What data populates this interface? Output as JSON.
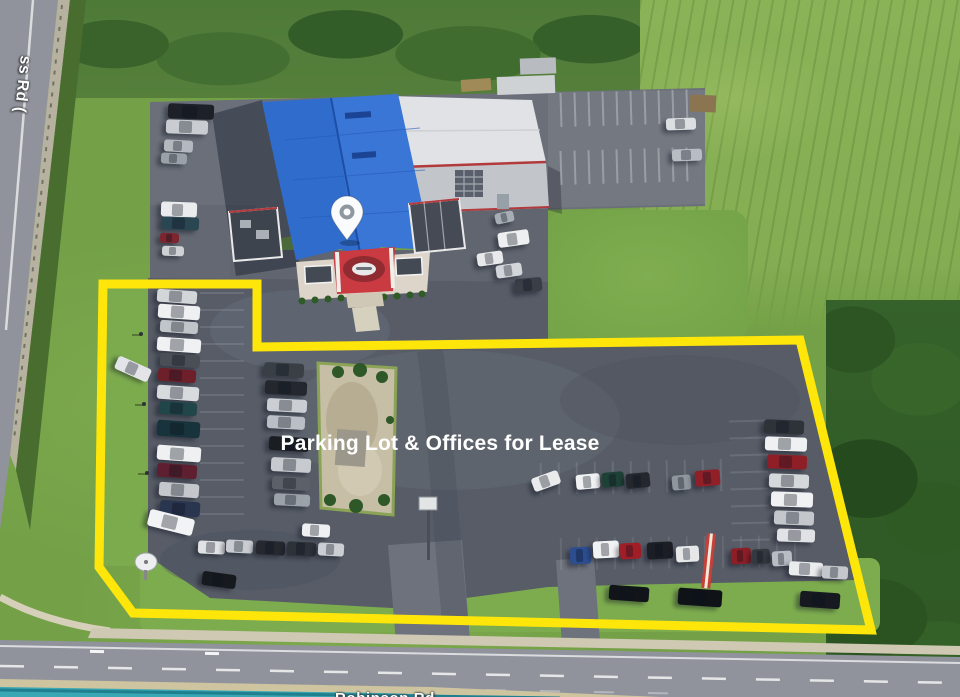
{
  "title": "Aerial property photo with lease highlight",
  "banner": {
    "label": "Parking Lot & Offices for Lease",
    "background": "#e32128",
    "text_color": "#ffffff"
  },
  "map_labels": {
    "bottom_road": "Robinson Rd",
    "left_road_fragment": "ss Rd ("
  },
  "marker": {
    "name": "location-pin",
    "fill": "#fafbfc",
    "dot": "#8f979f"
  },
  "lease_outline": {
    "color": "#ffe60a",
    "stroke_width": "9",
    "points": "103,284 257,284 257,347 800,340 871,630 133,613 99,567"
  },
  "palette": {
    "banner_red": "#e32128",
    "outline_yellow": "#ffe60a",
    "roof_blue": "#2f6ccb",
    "roof_white": "#e0e2e5",
    "asphalt": "#575c67",
    "road_gray": "#90939b",
    "grass": "#74a147",
    "trees_dark": "#2f5a24",
    "stream_teal": "#3aa7b4"
  },
  "scene": {
    "car_fields": [
      "x",
      "y",
      "w",
      "h",
      "angle_deg",
      "color"
    ],
    "cars": [
      [
        168,
        104,
        46,
        15,
        2,
        "#1d2026"
      ],
      [
        166,
        120,
        42,
        14,
        2,
        "#c9ccd1"
      ],
      [
        164,
        140,
        29,
        12,
        3,
        "#b3b9bf"
      ],
      [
        161,
        153,
        26,
        11,
        3,
        "#9aa1a8"
      ],
      [
        161,
        202,
        36,
        15,
        2,
        "#e9ebec"
      ],
      [
        161,
        217,
        38,
        13,
        2,
        "#2b4653"
      ],
      [
        160,
        233,
        19,
        10,
        2,
        "#7c2630"
      ],
      [
        162,
        246,
        22,
        10,
        2,
        "#ced2d5"
      ],
      [
        666,
        118,
        30,
        12,
        -2,
        "#dcdfe2"
      ],
      [
        672,
        149,
        30,
        12,
        -2,
        "#b8bdc3"
      ],
      [
        495,
        212,
        19,
        11,
        -12,
        "#a7adb4"
      ],
      [
        498,
        231,
        31,
        15,
        -8,
        "#edeff0"
      ],
      [
        515,
        278,
        27,
        14,
        -5,
        "#3a3f47"
      ],
      [
        477,
        252,
        26,
        13,
        -8,
        "#e7e9ea"
      ],
      [
        496,
        264,
        26,
        13,
        -8,
        "#d2d5d9"
      ],
      [
        157,
        290,
        40,
        13,
        4,
        "#d3d6d9"
      ],
      [
        158,
        305,
        42,
        14,
        4,
        "#eef0f1"
      ],
      [
        160,
        321,
        38,
        12,
        4,
        "#c0c5ca"
      ],
      [
        157,
        338,
        44,
        14,
        4,
        "#f0f1f2"
      ],
      [
        160,
        354,
        40,
        13,
        4,
        "#4a4f57"
      ],
      [
        158,
        369,
        38,
        13,
        4,
        "#6d2029"
      ],
      [
        157,
        386,
        42,
        14,
        4,
        "#d8dbde"
      ],
      [
        159,
        402,
        38,
        13,
        4,
        "#20464a"
      ],
      [
        157,
        421,
        43,
        16,
        4,
        "#18333b"
      ],
      [
        157,
        446,
        44,
        15,
        4,
        "#eff0f1"
      ],
      [
        157,
        464,
        40,
        14,
        4,
        "#5e2030"
      ],
      [
        159,
        483,
        40,
        14,
        4,
        "#c4c8cd"
      ],
      [
        160,
        501,
        40,
        15,
        4,
        "#2a3550"
      ],
      [
        115,
        362,
        36,
        14,
        24,
        "#e2e4e7"
      ],
      [
        148,
        514,
        46,
        17,
        14,
        "#f2f3f4"
      ],
      [
        198,
        541,
        27,
        13,
        3,
        "#e0e2e5"
      ],
      [
        226,
        540,
        27,
        13,
        3,
        "#c9cdd1"
      ],
      [
        256,
        541,
        29,
        14,
        3,
        "#25292f"
      ],
      [
        287,
        542,
        29,
        14,
        3,
        "#2d3138"
      ],
      [
        318,
        543,
        26,
        13,
        3,
        "#cbcfd3"
      ],
      [
        302,
        524,
        28,
        13,
        3,
        "#eef0f1"
      ],
      [
        202,
        573,
        34,
        14,
        8,
        "#16191e"
      ],
      [
        264,
        363,
        40,
        14,
        3,
        "#3a3f46"
      ],
      [
        265,
        381,
        42,
        14,
        3,
        "#24282e"
      ],
      [
        267,
        399,
        40,
        13,
        3,
        "#cbcfd4"
      ],
      [
        267,
        416,
        38,
        13,
        3,
        "#babfc5"
      ],
      [
        269,
        437,
        40,
        14,
        3,
        "#1a1d22"
      ],
      [
        271,
        458,
        40,
        14,
        3,
        "#c7cbd0"
      ],
      [
        272,
        477,
        38,
        13,
        3,
        "#5c6169"
      ],
      [
        274,
        494,
        36,
        12,
        3,
        "#9ca2a9"
      ],
      [
        532,
        474,
        28,
        14,
        -20,
        "#e9ebec"
      ],
      [
        576,
        474,
        24,
        15,
        -5,
        "#f0f1f2"
      ],
      [
        602,
        472,
        22,
        15,
        -5,
        "#1e4136"
      ],
      [
        626,
        473,
        24,
        15,
        -5,
        "#24272d"
      ],
      [
        672,
        475,
        19,
        15,
        -5,
        "#8f969d"
      ],
      [
        695,
        470,
        25,
        16,
        -5,
        "#901f28"
      ],
      [
        570,
        547,
        21,
        17,
        -3,
        "#2c4e90"
      ],
      [
        593,
        541,
        26,
        17,
        -3,
        "#f1f2f3"
      ],
      [
        620,
        543,
        21,
        16,
        -3,
        "#a21e27"
      ],
      [
        647,
        542,
        26,
        17,
        -3,
        "#1b1e24"
      ],
      [
        676,
        546,
        23,
        16,
        -3,
        "#e5e7e9"
      ],
      [
        731,
        548,
        20,
        16,
        -3,
        "#8d1e26"
      ],
      [
        752,
        549,
        18,
        15,
        -3,
        "#34383f"
      ],
      [
        772,
        551,
        20,
        15,
        -3,
        "#b8bdc3"
      ],
      [
        764,
        420,
        40,
        14,
        2,
        "#2e3239"
      ],
      [
        765,
        437,
        42,
        14,
        2,
        "#eef0f1"
      ],
      [
        767,
        455,
        40,
        14,
        2,
        "#8f1f27"
      ],
      [
        769,
        474,
        40,
        14,
        2,
        "#d5d8db"
      ],
      [
        771,
        492,
        42,
        15,
        2,
        "#f0f1f2"
      ],
      [
        774,
        511,
        40,
        14,
        2,
        "#c3c7cc"
      ],
      [
        777,
        529,
        38,
        13,
        2,
        "#e0e2e5"
      ],
      [
        789,
        562,
        34,
        14,
        3,
        "#eaecee"
      ],
      [
        822,
        566,
        26,
        13,
        3,
        "#c4c8cc"
      ],
      [
        609,
        586,
        40,
        15,
        4,
        "#111419"
      ],
      [
        678,
        589,
        44,
        17,
        4,
        "#0f1217"
      ],
      [
        800,
        592,
        40,
        16,
        4,
        "#16191f"
      ]
    ]
  }
}
